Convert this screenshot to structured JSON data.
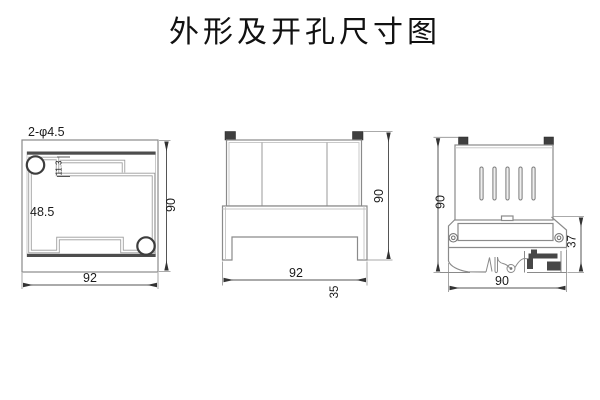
{
  "title": "外形及开孔尺寸图",
  "views": {
    "front": {
      "label_holes": "2-φ4.5",
      "dim_width": "92",
      "dim_height": "90",
      "dim_inner": "48.5",
      "dim_notch": "11.3"
    },
    "side": {
      "dim_width": "92",
      "dim_height": "90",
      "dim_depth": "35"
    },
    "rail": {
      "dim_height": "90",
      "dim_bottom": "90",
      "dim_clip": "37"
    }
  }
}
